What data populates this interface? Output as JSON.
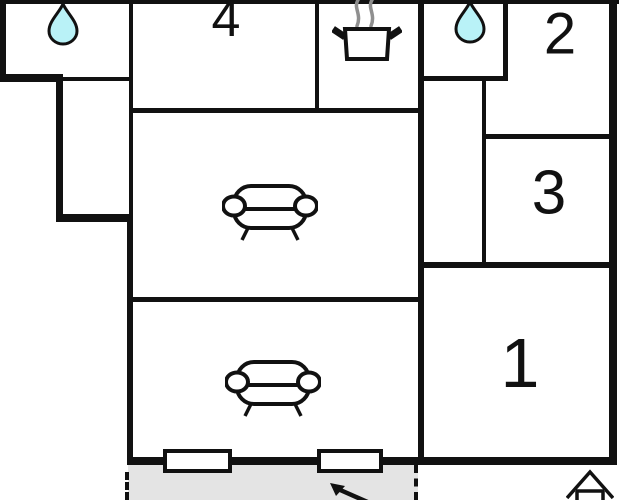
{
  "floorplan": {
    "rooms": [
      {
        "id": "room-1",
        "label": "1"
      },
      {
        "id": "room-2",
        "label": "2"
      },
      {
        "id": "room-3",
        "label": "3"
      },
      {
        "id": "room-4",
        "label": "4"
      }
    ],
    "icons": [
      {
        "name": "water-drop-icon",
        "area": "bathroom-top-left"
      },
      {
        "name": "water-drop-icon",
        "area": "bathroom-top-center-right"
      },
      {
        "name": "cooking-pot-icon",
        "area": "kitchen"
      },
      {
        "name": "sofa-icon",
        "area": "living-area-upper"
      },
      {
        "name": "sofa-icon",
        "area": "living-area-lower"
      },
      {
        "name": "entrance-arrow-icon",
        "area": "terrace"
      },
      {
        "name": "house-icon",
        "area": "bottom-right"
      }
    ],
    "windows_count": "2",
    "colors": {
      "wall": "#111111",
      "water_drop_fill": "#b9f2f7",
      "steam": "#8f8f8f",
      "terrace_fill": "#e4e4e4",
      "background": "#ffffff"
    }
  }
}
